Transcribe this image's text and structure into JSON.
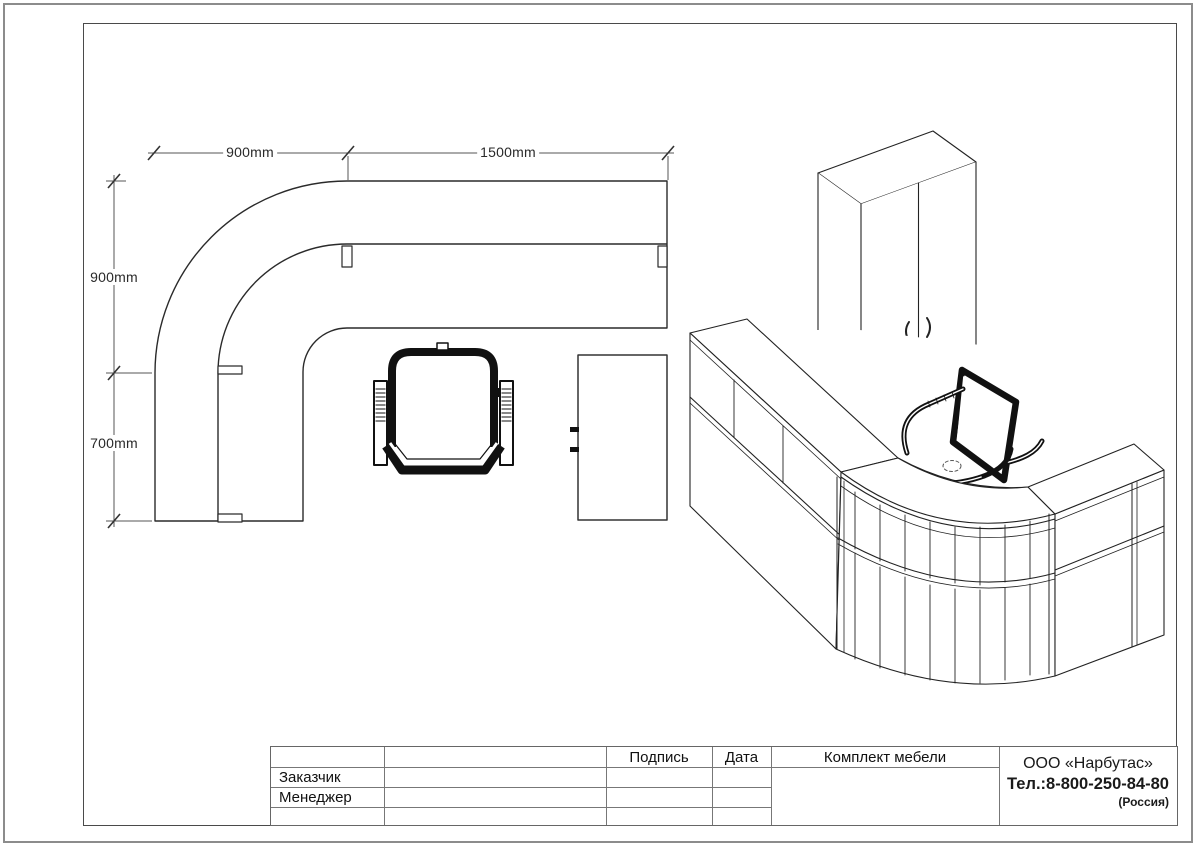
{
  "sheet": {
    "dimensions": {
      "top_left": "900mm",
      "top_right": "1500mm",
      "side_upper": "900mm",
      "side_lower": "700mm"
    },
    "title_block": {
      "customer_label": "Заказчик",
      "manager_label": "Менеджер",
      "signature_label": "Подпись",
      "date_label": "Дата",
      "set_label": "Комплект мебели",
      "company_name": "ООО «Нарбутас»",
      "company_phone": "Тел.:8-800-250-84-80",
      "company_country": "(Россия)"
    },
    "palette": {
      "line": "#222222",
      "dim_line": "#555555",
      "frame": "#4a4a4a",
      "page_border": "#8c8c8c"
    }
  }
}
